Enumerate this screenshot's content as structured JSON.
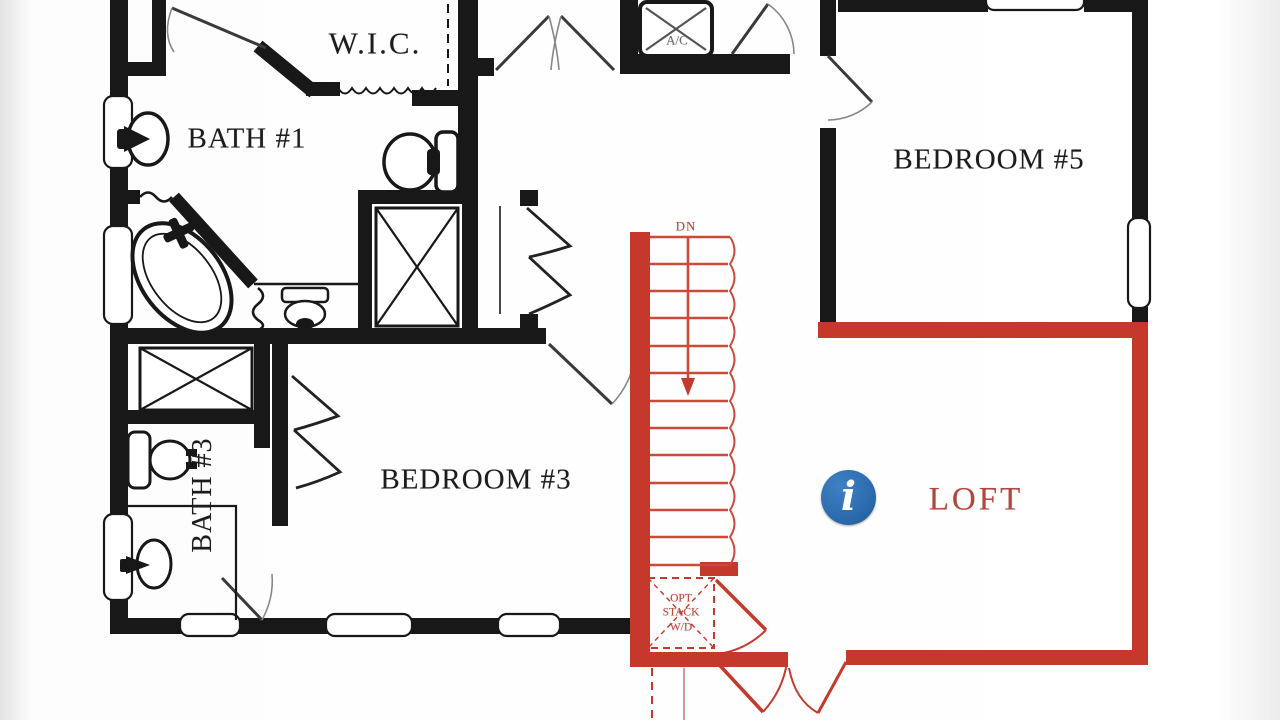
{
  "meta": {
    "view_title": "Second Floor Plan",
    "highlighted_area": "LOFT"
  },
  "colors": {
    "wall_black": "#181818",
    "highlight_red": "#c5392c",
    "tread_red": "#cc4a3a",
    "label_red": "#b5443c",
    "info_blue": "#2d6db0",
    "background": "#ffffff"
  },
  "rooms": {
    "wic": {
      "label": "W.I.C."
    },
    "bath1": {
      "label": "BATH #1"
    },
    "ac_closet": {
      "label": "A/C"
    },
    "bedroom5": {
      "label": "BEDROOM #5"
    },
    "bedroom3": {
      "label": "BEDROOM #3"
    },
    "bath3": {
      "label": "BATH #3"
    },
    "loft": {
      "label": "LOFT"
    },
    "stairs": {
      "direction_label": "DN"
    },
    "wd_closet": {
      "line1": "OPT",
      "line2": "STACK",
      "line3": "W/D"
    }
  },
  "icons": {
    "info": {
      "glyph": "i",
      "meaning": "information hotspot"
    }
  }
}
